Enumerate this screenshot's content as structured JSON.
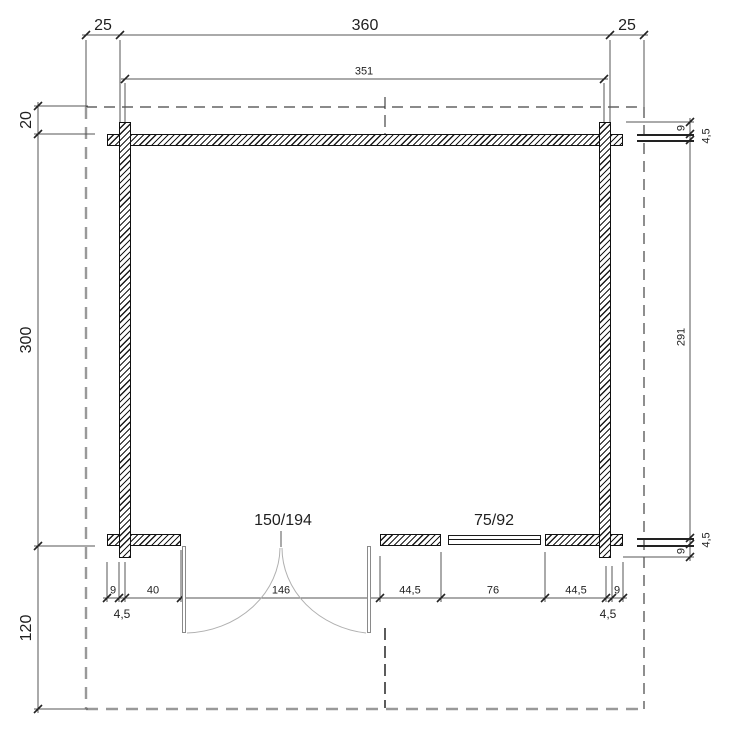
{
  "drawing": {
    "type": "floor-plan",
    "units": "cm",
    "colors": {
      "line": "#222222",
      "dim_line": "#555555",
      "roof_dash_dark": "#444444",
      "roof_dash_gray": "#999999",
      "door_swing": "#b0b0b0"
    }
  },
  "dims": {
    "top_overhang_left": "25",
    "top_width_overall": "360",
    "top_overhang_right": "25",
    "top_width_walls": "351",
    "left_overhang_top": "20",
    "left_depth_overall": "300",
    "left_overhang_bottom": "120",
    "right_top_log": "9",
    "right_top_half": "4,5",
    "right_depth_inner": "291",
    "right_bottom_half": "4,5",
    "right_bottom_log": "9",
    "bottom_log_left": "9",
    "bottom_half_left": "4,5",
    "bottom_seg_40": "40",
    "bottom_door_width": "146",
    "bottom_seg_left_of_window": "44,5",
    "bottom_window_width": "76",
    "bottom_seg_right_of_window": "44,5",
    "bottom_half_right": "4,5",
    "bottom_log_right": "9"
  },
  "openings": {
    "door_size": "150/194",
    "window_size": "75/92"
  }
}
